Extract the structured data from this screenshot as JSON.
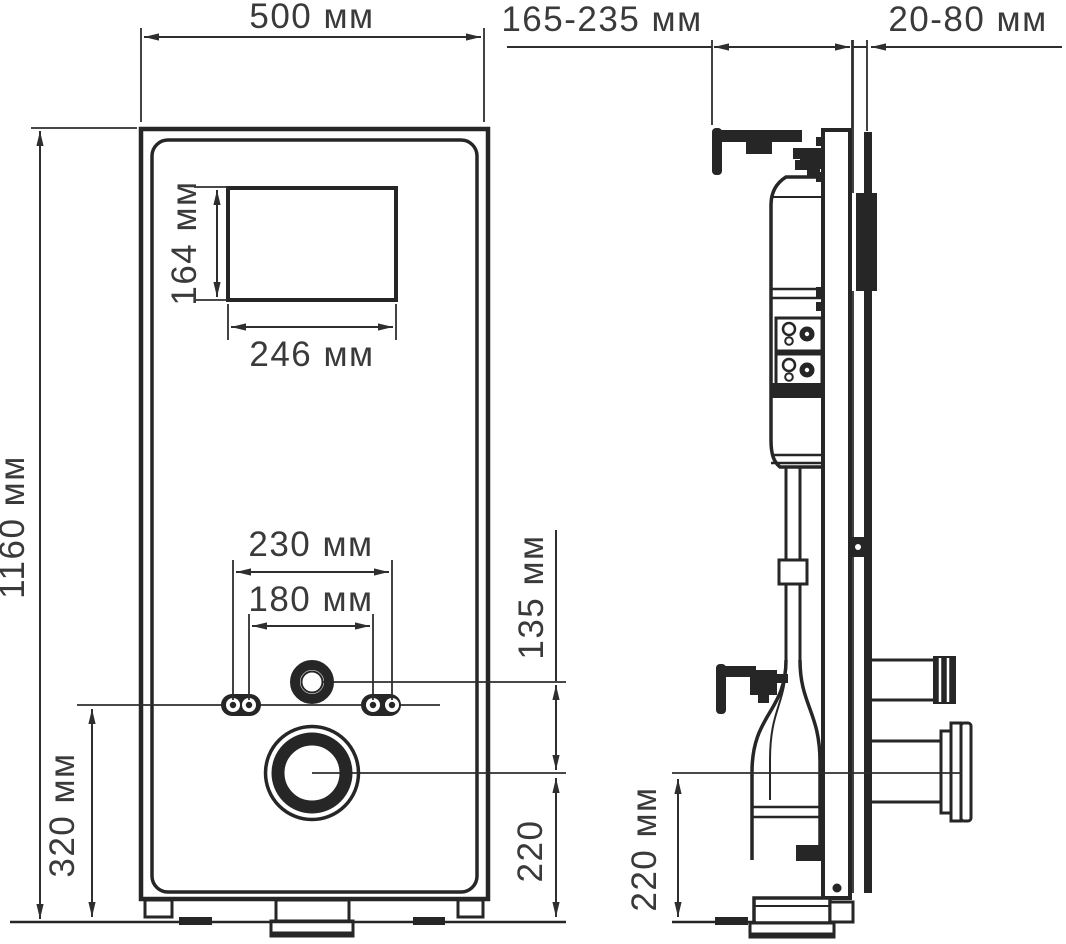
{
  "front_view": {
    "width_label": "500 мм",
    "height_label": "1160 мм",
    "opening_height_label": "164 мм",
    "opening_width_label": "246 мм",
    "mount_outer_label": "230 мм",
    "mount_inner_label": "180 мм",
    "inlet_offset_label": "135 мм",
    "mount_height_label": "320 мм",
    "outlet_height_label": "220"
  },
  "side_view": {
    "depth_range_label": "165-235 мм",
    "wall_offset_label": "20-80 мм",
    "outlet_height_label": "220 мм"
  }
}
